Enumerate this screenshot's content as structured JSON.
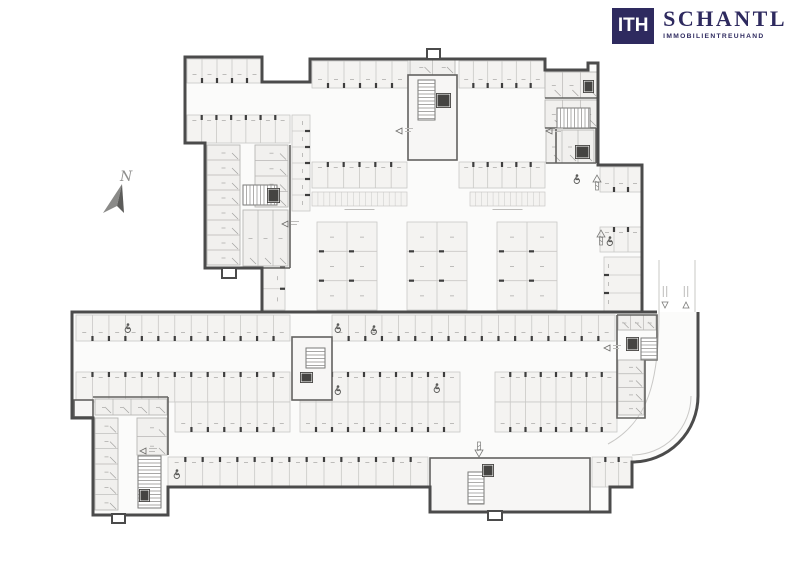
{
  "logo": {
    "monogram": "ITH",
    "name": "SCHANTL",
    "subtitle": "IMMOBILIENTREUHAND",
    "color": "#2e2a5f"
  },
  "compass": {
    "label": "N"
  },
  "colors": {
    "wall": "#4b4b4b",
    "wall_medium": "#636260",
    "line": "#c9c8c6",
    "room_line": "#b7b6b4",
    "stall_fill": "#f4f3f1",
    "room_fill": "#f1f0ee",
    "paper_fill": "#fbfbfa",
    "tick": "#3e3e3e",
    "icon": "#5a5a58",
    "faint": "#bdbcba"
  },
  "plan": {
    "stall_rows": [
      {
        "x": 187,
        "y": 59,
        "w": 75,
        "h": 24,
        "n": 5,
        "t": "b"
      },
      {
        "x": 187,
        "y": 115,
        "w": 103,
        "h": 28,
        "n": 7,
        "t": "t"
      },
      {
        "x": 312,
        "y": 61,
        "w": 96,
        "h": 27,
        "n": 6,
        "t": "b"
      },
      {
        "x": 459,
        "y": 61,
        "w": 86,
        "h": 27,
        "n": 6,
        "t": "b"
      },
      {
        "x": 312,
        "y": 162,
        "w": 95,
        "h": 26,
        "n": 6,
        "t": "t"
      },
      {
        "x": 459,
        "y": 162,
        "w": 86,
        "h": 26,
        "n": 6,
        "t": "t"
      },
      {
        "x": 600,
        "y": 167,
        "w": 42,
        "h": 25,
        "n": 3,
        "t": "b"
      },
      {
        "x": 600,
        "y": 227,
        "w": 42,
        "h": 25,
        "n": 3,
        "t": "t"
      },
      {
        "x": 76,
        "y": 315,
        "w": 214,
        "h": 26,
        "n": 13,
        "t": "b"
      },
      {
        "x": 332,
        "y": 315,
        "w": 283,
        "h": 26,
        "n": 17,
        "t": "b"
      },
      {
        "x": 76,
        "y": 372,
        "w": 214,
        "h": 30,
        "n": 13,
        "t": "t"
      },
      {
        "x": 300,
        "y": 372,
        "w": 160,
        "h": 30,
        "n": 10,
        "t": "t"
      },
      {
        "x": 495,
        "y": 372,
        "w": 122,
        "h": 30,
        "n": 8,
        "t": "t"
      },
      {
        "x": 175,
        "y": 402,
        "w": 115,
        "h": 30,
        "n": 7,
        "t": "b"
      },
      {
        "x": 300,
        "y": 402,
        "w": 160,
        "h": 30,
        "n": 10,
        "t": "b"
      },
      {
        "x": 495,
        "y": 402,
        "w": 122,
        "h": 30,
        "n": 8,
        "t": "b"
      },
      {
        "x": 168,
        "y": 457,
        "w": 260,
        "h": 30,
        "n": 15,
        "t": "t"
      },
      {
        "x": 592,
        "y": 457,
        "w": 40,
        "h": 30,
        "n": 3,
        "t": "t"
      },
      {
        "x": 604,
        "y": 257,
        "w": 38,
        "h": 54,
        "n": 3,
        "t": "l",
        "dir": "h"
      },
      {
        "x": 262,
        "y": 225,
        "w": 23,
        "h": 85,
        "n": 4,
        "t": "r",
        "dir": "h"
      },
      {
        "x": 292,
        "y": 115,
        "w": 18,
        "h": 96,
        "n": 6,
        "t": "r",
        "dir": "h"
      }
    ],
    "bike_rows": [
      {
        "x": 312,
        "y": 192,
        "w": 95,
        "h": 14,
        "n": 16
      },
      {
        "x": 470,
        "y": 192,
        "w": 75,
        "h": 14,
        "n": 13
      }
    ],
    "islands": [
      {
        "x": 317,
        "y": 222,
        "w": 60,
        "h": 88
      },
      {
        "x": 407,
        "y": 222,
        "w": 60,
        "h": 88
      },
      {
        "x": 497,
        "y": 222,
        "w": 60,
        "h": 88
      }
    ],
    "room_strips": [
      {
        "x": 207,
        "y": 145,
        "w": 33,
        "h": 120,
        "n": 8,
        "dir": "h"
      },
      {
        "x": 255,
        "y": 145,
        "w": 33,
        "h": 62,
        "n": 4,
        "dir": "h"
      },
      {
        "x": 243,
        "y": 210,
        "w": 45,
        "h": 56,
        "n": 3,
        "dir": "v"
      },
      {
        "x": 410,
        "y": 59,
        "w": 45,
        "h": 16,
        "n": 2,
        "dir": "v"
      },
      {
        "x": 410,
        "y": 135,
        "w": 45,
        "h": 23,
        "n": 3,
        "dir": "v"
      },
      {
        "x": 545,
        "y": 72,
        "w": 53,
        "h": 26,
        "n": 3,
        "dir": "v"
      },
      {
        "x": 545,
        "y": 100,
        "w": 53,
        "h": 28,
        "n": 3,
        "dir": "v"
      },
      {
        "x": 546,
        "y": 130,
        "w": 48,
        "h": 33,
        "n": 3,
        "dir": "v"
      },
      {
        "x": 618,
        "y": 315,
        "w": 38,
        "h": 15,
        "n": 3,
        "dir": "v"
      },
      {
        "x": 618,
        "y": 360,
        "w": 26,
        "h": 55,
        "n": 4,
        "dir": "h"
      },
      {
        "x": 95,
        "y": 399,
        "w": 72,
        "h": 16,
        "n": 4,
        "dir": "v"
      },
      {
        "x": 95,
        "y": 418,
        "w": 23,
        "h": 92,
        "n": 6,
        "dir": "h"
      },
      {
        "x": 137,
        "y": 418,
        "w": 30,
        "h": 37,
        "n": 2,
        "dir": "h"
      },
      {
        "x": 431,
        "y": 459,
        "w": 50,
        "h": 19,
        "n": 4,
        "dir": "v"
      },
      {
        "x": 431,
        "y": 480,
        "w": 26,
        "h": 30,
        "n": 2,
        "dir": "h"
      },
      {
        "x": 496,
        "y": 459,
        "w": 93,
        "h": 20,
        "n": 5,
        "dir": "v"
      },
      {
        "x": 496,
        "y": 482,
        "w": 93,
        "h": 29,
        "n": 5,
        "dir": "v"
      },
      {
        "x": 293,
        "y": 338,
        "w": 38,
        "h": 14,
        "n": 2,
        "dir": "v"
      },
      {
        "x": 293,
        "y": 385,
        "w": 38,
        "h": 14,
        "n": 2,
        "dir": "v"
      },
      {
        "x": 74,
        "y": 400,
        "w": 19,
        "h": 17,
        "n": 1,
        "dir": "v"
      }
    ],
    "stairs": [
      {
        "x": 243,
        "y": 185,
        "w": 34,
        "h": 20,
        "dir": "h"
      },
      {
        "x": 418,
        "y": 80,
        "w": 17,
        "h": 40,
        "dir": "v"
      },
      {
        "x": 557,
        "y": 108,
        "w": 33,
        "h": 20,
        "dir": "h"
      },
      {
        "x": 306,
        "y": 348,
        "w": 19,
        "h": 20,
        "dir": "v"
      },
      {
        "x": 641,
        "y": 338,
        "w": 16,
        "h": 22,
        "dir": "v"
      },
      {
        "x": 468,
        "y": 472,
        "w": 16,
        "h": 32,
        "dir": "v"
      },
      {
        "x": 138,
        "y": 456,
        "w": 23,
        "h": 52,
        "dir": "v"
      }
    ],
    "elevators": [
      [
        267,
        188,
        13,
        15
      ],
      [
        436,
        93,
        15,
        15
      ],
      [
        583,
        80,
        11,
        13
      ],
      [
        575,
        145,
        15,
        14
      ],
      [
        300,
        372,
        13,
        11
      ],
      [
        626,
        337,
        13,
        14
      ],
      [
        482,
        464,
        12,
        13
      ],
      [
        139,
        489,
        11,
        13
      ]
    ],
    "handicap_spots": [
      [
        128,
        328
      ],
      [
        338,
        328
      ],
      [
        374,
        330
      ],
      [
        338,
        390
      ],
      [
        437,
        388
      ],
      [
        577,
        179
      ],
      [
        610,
        241
      ],
      [
        177,
        474
      ]
    ],
    "up_arrows": [
      {
        "x": 597,
        "y": 183,
        "dir": "up"
      },
      {
        "x": 601,
        "y": 238,
        "dir": "up"
      },
      {
        "x": 479,
        "y": 449,
        "dir": "down"
      }
    ],
    "ramp_labels": [
      {
        "x": 665,
        "y": 300,
        "dir": "down"
      },
      {
        "x": 686,
        "y": 300,
        "dir": "up"
      }
    ],
    "door_markers": [
      [
        288,
        224
      ],
      [
        402,
        131
      ],
      [
        552,
        131
      ],
      [
        610,
        348
      ],
      [
        146,
        451
      ]
    ],
    "protrusions": [
      [
        222,
        268,
        14,
        10
      ],
      [
        112,
        514,
        13,
        9
      ],
      [
        488,
        511,
        14,
        9
      ],
      [
        427,
        49,
        13,
        10
      ]
    ]
  }
}
